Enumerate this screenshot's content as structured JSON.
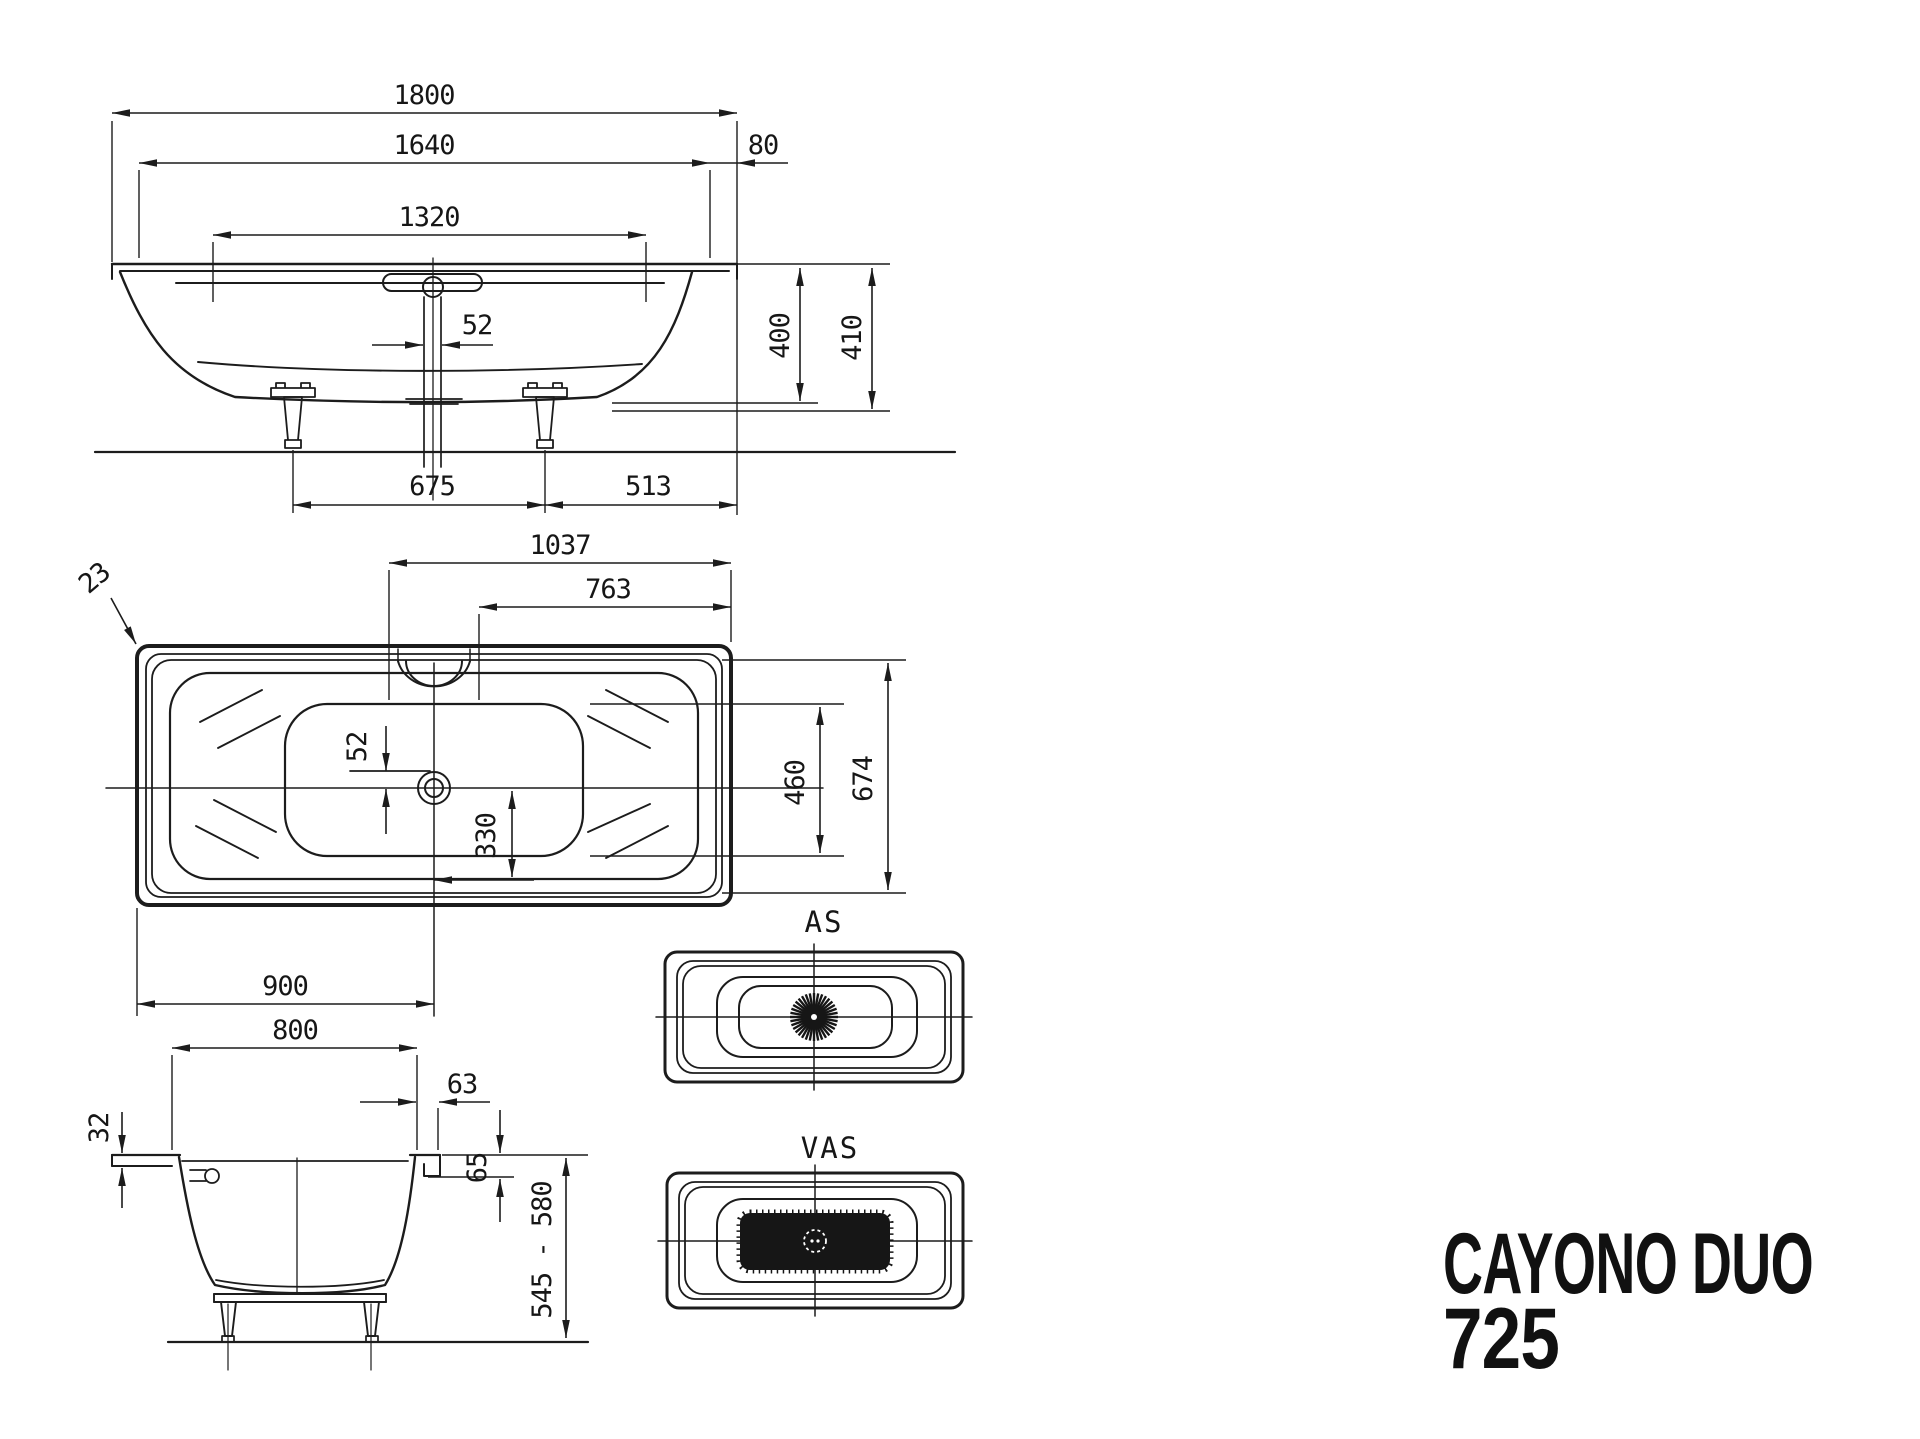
{
  "title": {
    "line1": "CAYONO DUO",
    "line2": "725"
  },
  "views": {
    "side_elevation": {
      "d1800": "1800",
      "d1640": "1640",
      "d1320": "1320",
      "d80": "80",
      "d52": "52",
      "d400": "400",
      "d410": "410",
      "d675": "675",
      "d513": "513"
    },
    "plan": {
      "d1037": "1037",
      "d763": "763",
      "d23": "23",
      "d52": "52",
      "d460": "460",
      "d674": "674",
      "d330": "330",
      "d900": "900"
    },
    "end_section": {
      "d800": "800",
      "d63": "63",
      "d32": "32",
      "d65": "65",
      "d545_580": "545 - 580"
    },
    "as_variant": {
      "label": "AS"
    },
    "vas_variant": {
      "label": "VAS"
    }
  },
  "colors": {
    "line_color": "#1c1c1c",
    "background": "#ffffff",
    "title_color": "#111111"
  }
}
